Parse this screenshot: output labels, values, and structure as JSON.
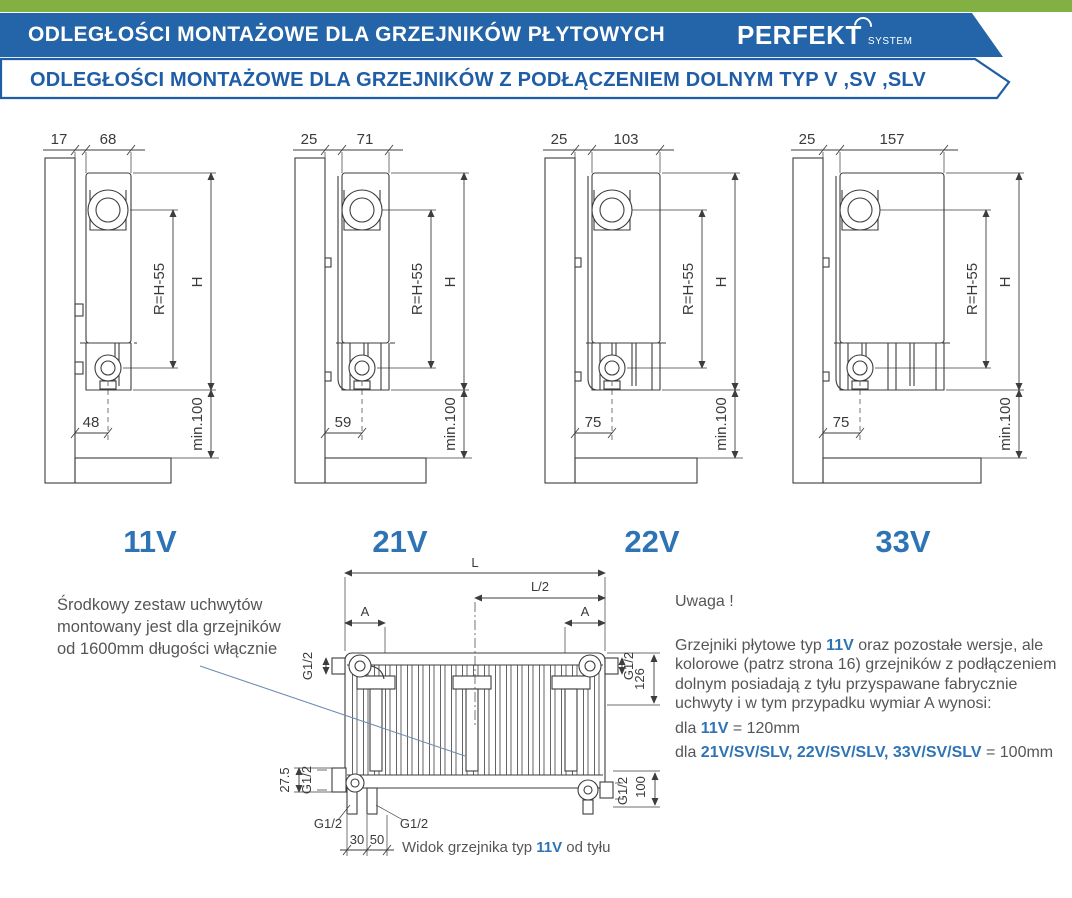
{
  "header": {
    "title": "ODLEGŁOŚCI MONTAŻOWE DLA GRZEJNIKÓW PŁYTOWYCH",
    "logo_main": "PERFEKT",
    "logo_sub": "SYSTEM",
    "subtitle": "ODLEGŁOŚCI MONTAŻOWE DLA GRZEJNIKÓW Z PODŁĄCZENIEM DOLNYM TYP V ,SV ,SLV"
  },
  "colors": {
    "green_strip": "#83b043",
    "banner_blue": "#2464a8",
    "subtitle_blue": "#1f5ea6",
    "accent_blue": "#2e74b5",
    "line": "#3d3d3d",
    "body_text": "#565656"
  },
  "diagrams": [
    {
      "label": "11V",
      "wall_gap": "17",
      "depth": "68",
      "r": "R=H-55",
      "h": "H",
      "floor_gap": "min.100",
      "bottom_offset": "48"
    },
    {
      "label": "21V",
      "wall_gap": "25",
      "depth": "71",
      "r": "R=H-55",
      "h": "H",
      "floor_gap": "min.100",
      "bottom_offset": "59"
    },
    {
      "label": "22V",
      "wall_gap": "25",
      "depth": "103",
      "r": "R=H-55",
      "h": "H",
      "floor_gap": "min.100",
      "bottom_offset": "75"
    },
    {
      "label": "33V",
      "wall_gap": "25",
      "depth": "157",
      "r": "R=H-55",
      "h": "H",
      "floor_gap": "min.100",
      "bottom_offset": "75"
    }
  ],
  "note_left": {
    "line1": "Środkowy zestaw uchwytów",
    "line2": "montowany jest dla grzejników",
    "line3": "od 1600mm długości włącznie"
  },
  "rear_view": {
    "dim_l": "L",
    "dim_l2": "L/2",
    "dim_a_left": "A",
    "dim_a_right": "A",
    "g12_top_left": "G1/2",
    "g12_top_right": "G1/2",
    "dim_126": "126",
    "dim_27_5": "27.5",
    "g12_bottom_left_side": "G1/2",
    "g12_bottom_left": "G1/2",
    "g12_bottom_mid": "G1/2",
    "dim_30": "30",
    "dim_50": "50",
    "g12_bottom_right": "G1/2",
    "dim_100": "100",
    "caption_prefix": "Widok grzejnika typ ",
    "caption_type": "11V",
    "caption_suffix": " od tyłu"
  },
  "uwaga": {
    "title": "Uwaga !",
    "p1_1": "Grzejniki płytowe typ ",
    "p1_type": "11V",
    "p1_2": " oraz pozostałe wersje, ale kolorowe (patrz strona 16) grzejników z podłączeniem dolnym posiadają z tyłu przyspawane fabrycznie uchwyty i w tym przypadku wymiar A wynosi:",
    "dla1_prefix": "dla ",
    "dla1_type": "11V",
    "dla1_value": " = 120mm",
    "dla2_prefix": "dla ",
    "dla2_types": "21V/SV/SLV, 22V/SV/SLV, 33V/SV/SLV",
    "dla2_value": " = 100mm"
  }
}
